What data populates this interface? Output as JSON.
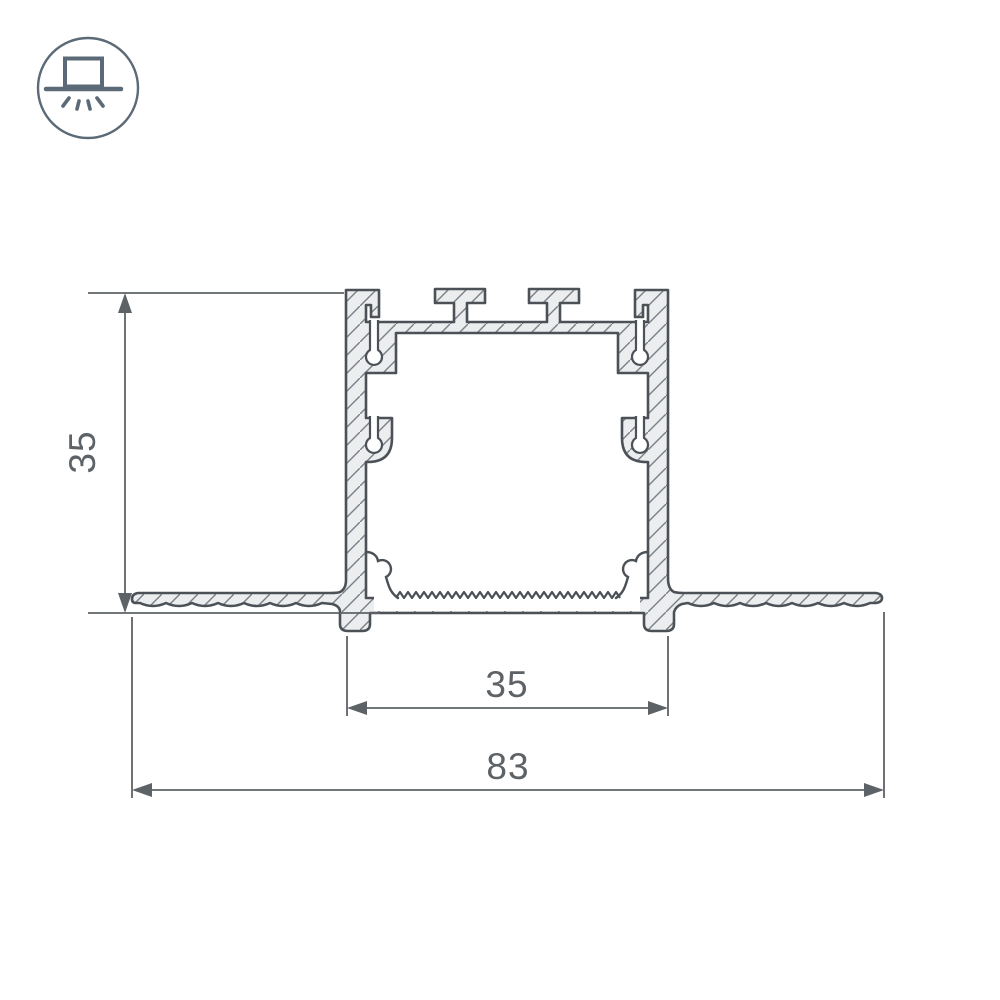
{
  "icon": {
    "name": "recessed-light-icon"
  },
  "drawing": {
    "type": "profile-cross-section",
    "dimensions": {
      "height": {
        "value": "35",
        "orientation": "vertical"
      },
      "body_width": {
        "value": "35",
        "orientation": "horizontal"
      },
      "overall_width": {
        "value": "83",
        "orientation": "horizontal"
      }
    },
    "colors": {
      "outline": "#4b5157",
      "section_fill": "#ecedee",
      "hatch_line": "#7a8086",
      "dimension": "#5d6266",
      "icon": "#5b6a76",
      "background": "#ffffff"
    }
  }
}
